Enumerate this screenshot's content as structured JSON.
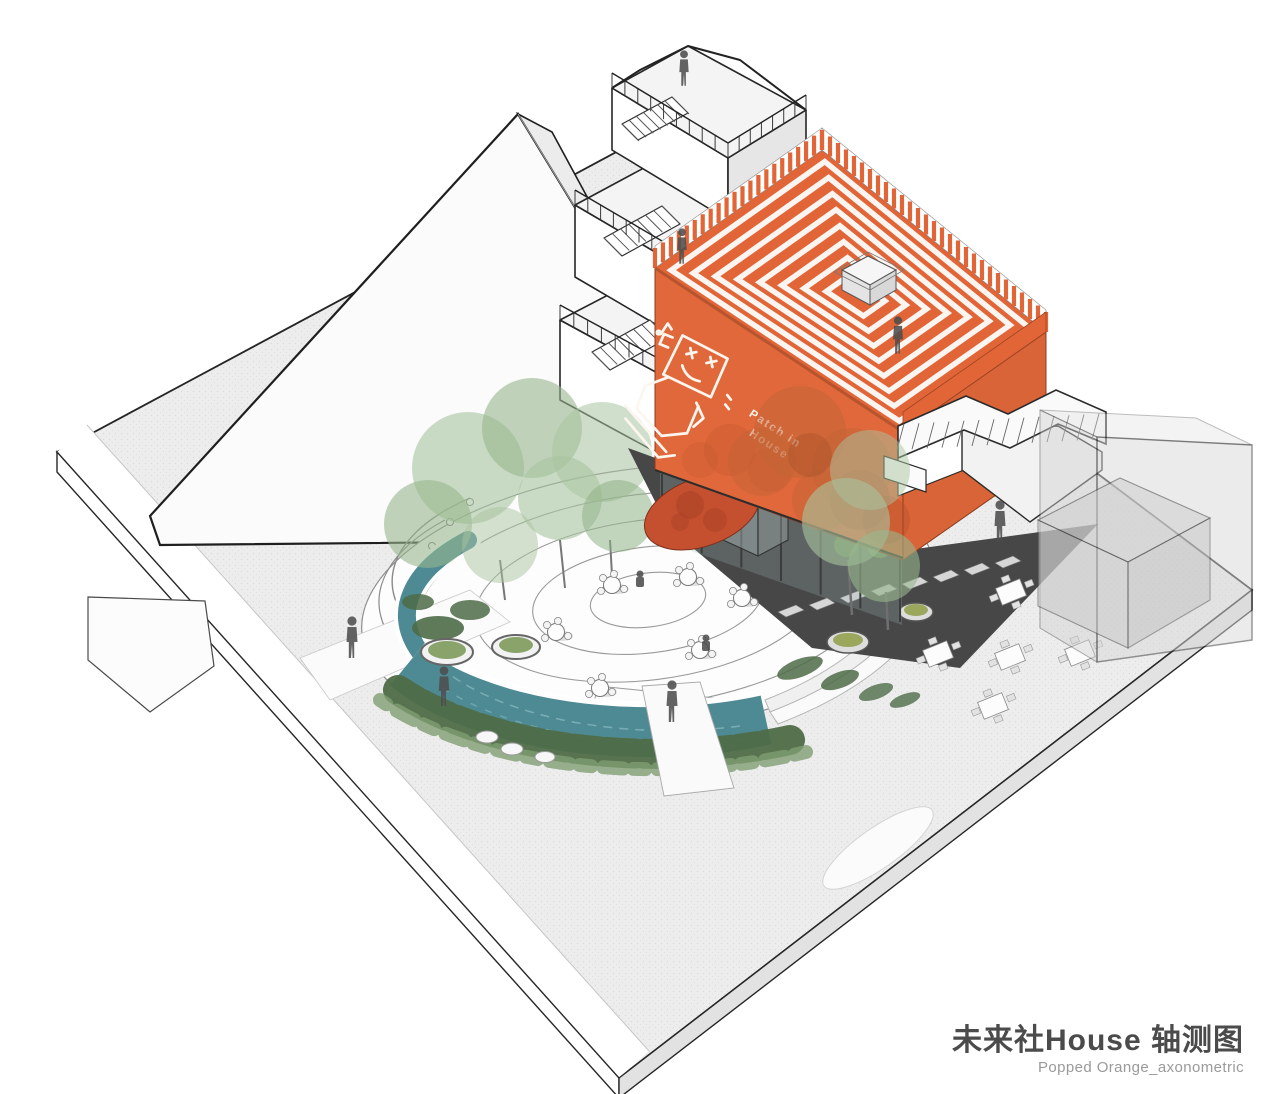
{
  "title_block": {
    "title": "未来社House 轴测图",
    "subtitle": "Popped Orange_axonometric"
  },
  "illustration": {
    "mural": {
      "line1": "Patch in",
      "line2": "House"
    }
  },
  "colors": {
    "accent-orange": "#E0683B",
    "roof-orange": "#E26537",
    "deep-orange": "#B5542D",
    "entry-red": "#C5502F",
    "water-teal": "#4E8A94",
    "foliage-green": "#A9C4A0",
    "shrub-green": "#4E6B47",
    "autumn-orange": "#C26335",
    "plaza-grey": "#EDEDED",
    "deck-grey": "#474747",
    "ink": "#262626",
    "title-grey": "#4B4B4B",
    "subtitle-grey": "#9A9A9A"
  }
}
